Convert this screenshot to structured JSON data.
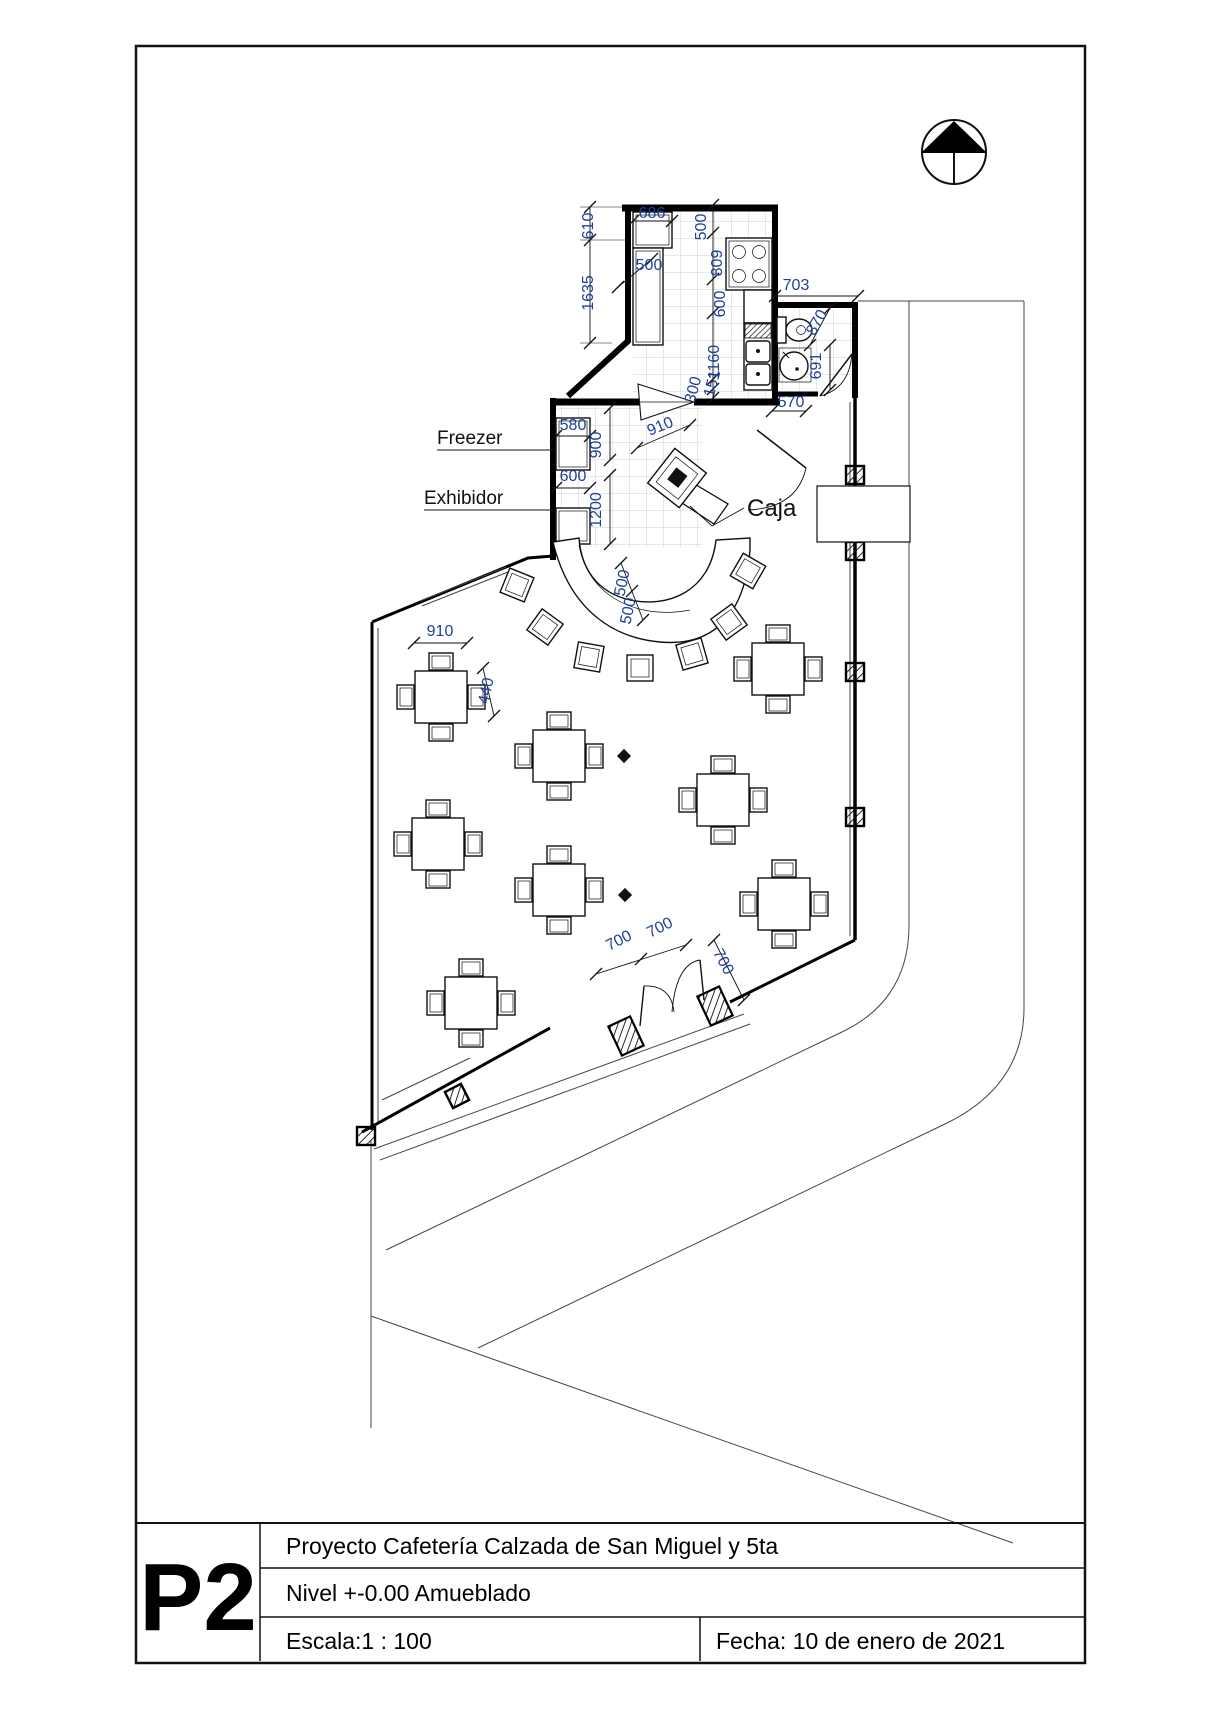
{
  "title_block": {
    "sheet_id": "P2",
    "project": "Proyecto Cafetería Calzada de San Miguel y 5ta",
    "level": "Nivel +-0.00 Amueblado",
    "scale": "Escala:1 : 100",
    "date": "Fecha: 10 de enero de 2021"
  },
  "plan": {
    "labels": {
      "freezer": "Freezer",
      "exhibidor": "Exhibidor",
      "caja": "Caja"
    },
    "dimensions_mm": {
      "kitchen": [
        "686",
        "610",
        "1635",
        "500",
        "500",
        "809",
        "600",
        "1160",
        "300",
        "151"
      ],
      "bathroom": [
        "703",
        "870",
        "691",
        "570"
      ],
      "service": [
        "580",
        "900",
        "910",
        "600",
        "1200"
      ],
      "counter": [
        "500",
        "500"
      ],
      "dining": [
        "910",
        "440"
      ],
      "entrance": [
        "700",
        "700",
        "700"
      ]
    },
    "furniture": {
      "dining_tables": 8,
      "bar_stools": 7
    }
  },
  "colors": {
    "dimension_text": "#20409a",
    "line": "#111111"
  }
}
